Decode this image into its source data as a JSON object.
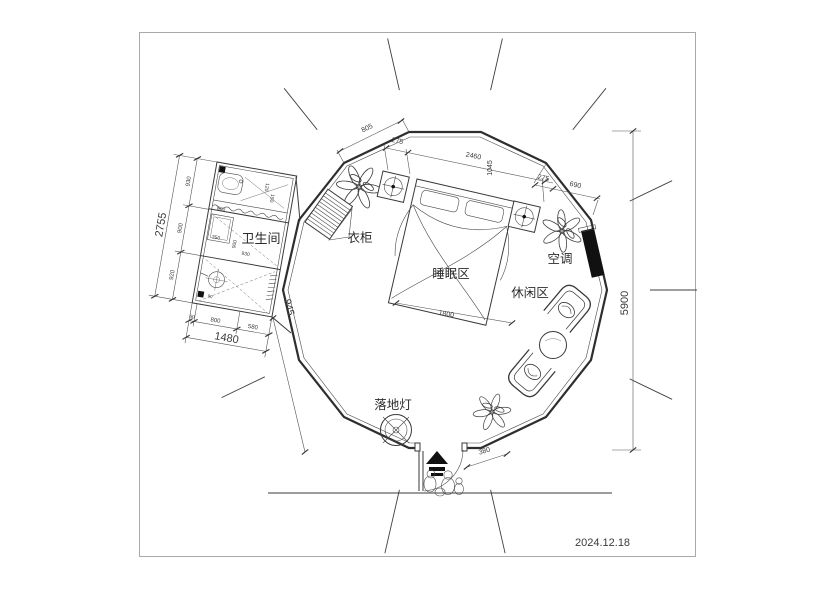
{
  "document": {
    "date": "2024.12.18"
  },
  "labels": {
    "bathroom": "卫生间",
    "wardrobe": "衣柜",
    "sleeping_area": "睡眠区",
    "leisure_area": "休闲区",
    "air_conditioner": "空调",
    "floor_lamp": "落地灯"
  },
  "dimensions": {
    "overall_height": "5900",
    "top_wall": "805",
    "top_275_left": "275",
    "top_span": "2460",
    "top_vertical": "1045",
    "top_275_right": "275",
    "top_690": "690",
    "bed_width": "1800",
    "entry_side": "380",
    "bath_right": "945",
    "bath_total_height": "2755",
    "bath_total_width": "1480",
    "bath_left_chain": [
      "930",
      "900",
      "920"
    ],
    "bath_bottom_chain": [
      "90",
      "800",
      "580"
    ],
    "bath_inner": {
      "shower": "350",
      "mid_w": "900",
      "mid_h": "930",
      "sink": "800",
      "top_a": "120",
      "top_b": "150",
      "drain": "90"
    }
  },
  "colors": {
    "wall": "#2e2e2e",
    "black_fill": "#111111",
    "frame": "#a9a9a9"
  }
}
